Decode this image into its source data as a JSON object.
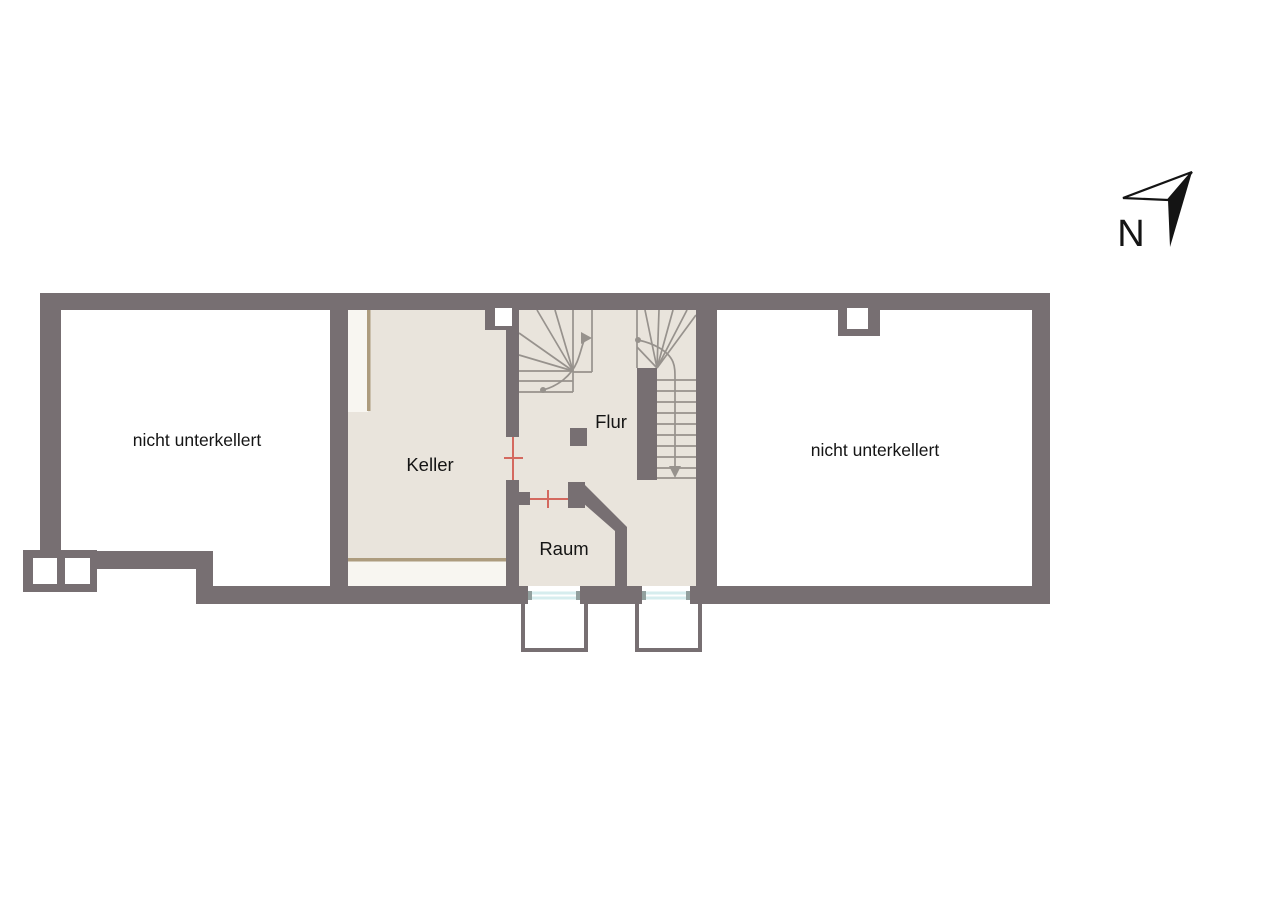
{
  "compass": {
    "label": "N"
  },
  "rooms": {
    "left_area": {
      "label": "nicht unterkellert"
    },
    "keller": {
      "label": "Keller"
    },
    "flur": {
      "label": "Flur"
    },
    "raum": {
      "label": "Raum"
    },
    "right_area": {
      "label": "nicht unterkellert"
    }
  },
  "colors": {
    "wall": "#776F72",
    "floor": "#E9E4DC",
    "strip": "#F8F6F1",
    "trim": "#AD9C7E",
    "stairline": "#97928D",
    "door": "#D4695F",
    "glass": "#D6EDEE",
    "glasscap": "#92A09E",
    "ink": "#141414",
    "bg": "#FFFFFF"
  }
}
